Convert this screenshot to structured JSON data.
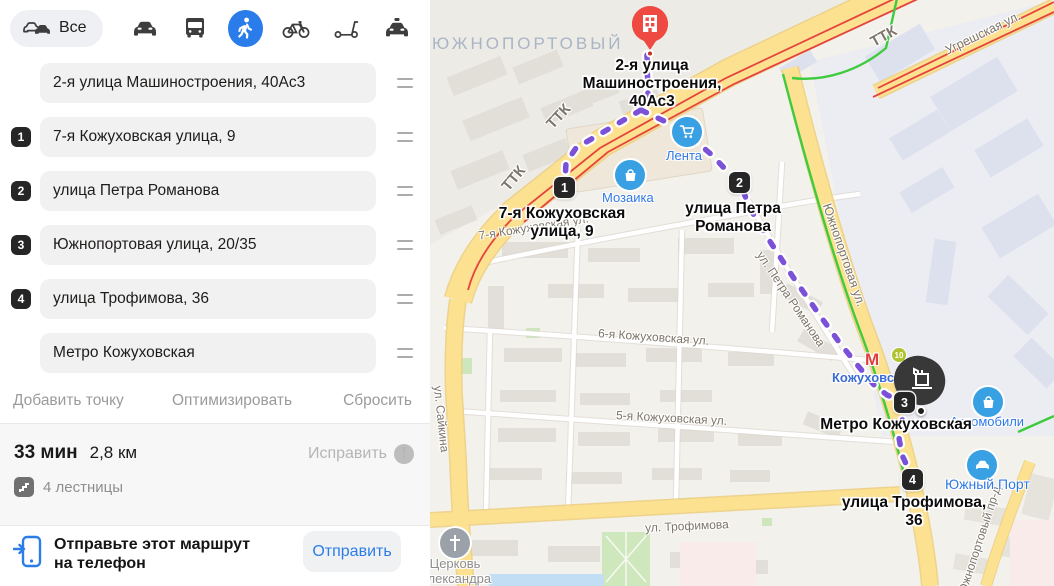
{
  "toolbar": {
    "all_label": "Все",
    "modes": [
      {
        "name": "traffic-all",
        "selected": false
      },
      {
        "name": "car",
        "selected": false
      },
      {
        "name": "bus",
        "selected": false
      },
      {
        "name": "walk",
        "selected": true
      },
      {
        "name": "bike",
        "selected": false
      },
      {
        "name": "scooter",
        "selected": false
      },
      {
        "name": "taxi",
        "selected": false
      }
    ]
  },
  "route": {
    "points": [
      {
        "type": "start",
        "label": "2-я улица Машиностроения, 40Ас3"
      },
      {
        "type": "stop",
        "num": "1",
        "label": "7-я Кожуховская улица, 9"
      },
      {
        "type": "stop",
        "num": "2",
        "label": "улица Петра Романова"
      },
      {
        "type": "stop",
        "num": "3",
        "label": "Южнопортовая улица, 20/35"
      },
      {
        "type": "stop",
        "num": "4",
        "label": "улица Трофимова, 36"
      },
      {
        "type": "end",
        "label": "Метро Кожуховская"
      }
    ],
    "actions": {
      "add": "Добавить точку",
      "optimize": "Оптимизировать",
      "reset": "Сбросить"
    }
  },
  "summary": {
    "duration": "33 мин",
    "distance": "2,8 км",
    "fix_label": "Исправить",
    "warning_icon": "exclamation-circle",
    "stairs": "4 лестницы"
  },
  "send": {
    "message_line1": "Отправьте этот маршрут",
    "message_line2": "на телефон",
    "button": "Отправить"
  },
  "map": {
    "district": "ЮЖНОПОРТОВЫЙ",
    "roads": {
      "ttk": "ТТК",
      "ugreshskaya": "Угрешская ул.",
      "yuzhnoportovaya": "Южнопортовая ул.",
      "saikina": "ул. Сайкина",
      "trofimova": "ул. Трофимова",
      "kozhukhovskaya5": "5-я Кожуховская ул.",
      "kozhukhovskaya6": "6-я Кожуховская ул.",
      "kozhukhovskaya7": "7-я Кожуховская ул.",
      "petra_romanova": "ул. Петра Романова",
      "yuzhnoportovy_proezd": "Южнопортовый пр-д"
    },
    "pois": {
      "lenta": {
        "label": "Лента",
        "icon": "shopping-cart"
      },
      "mozaika": {
        "label": "Мозаика",
        "icon": "shopping-bag"
      },
      "avtomobili": {
        "label": "Автомобили",
        "icon": "shopping-bag"
      },
      "yuzhny_port": {
        "label": "Южный Порт",
        "icon": "car"
      },
      "church": {
        "label_line1": "Церковь",
        "label_line2": "Александра",
        "icon": "cross"
      }
    },
    "metro": {
      "letter": "М",
      "station": "Кожуховская",
      "line_badge": "10"
    },
    "waypoints": {
      "start_label": "2-я улица Машиностроения, 40Ас3",
      "p1": "1",
      "p1_label": "7-я Кожуховская улица, 9",
      "p2": "2",
      "p2_label": "улица Петра Романова",
      "p3": "3",
      "p4": "4",
      "p4_label": "улица Трофимова, 36",
      "end_label": "Метро Кожуховская"
    },
    "colors": {
      "route_purple": "#7b51d8",
      "start_red": "#f23b34",
      "accent_blue": "#2b7de9",
      "selected_mode_bg": "#2a7ceb",
      "road_yellow": "#fce191",
      "transit_green": "#3ecb3e",
      "traffic_red": "#e4443d"
    }
  }
}
